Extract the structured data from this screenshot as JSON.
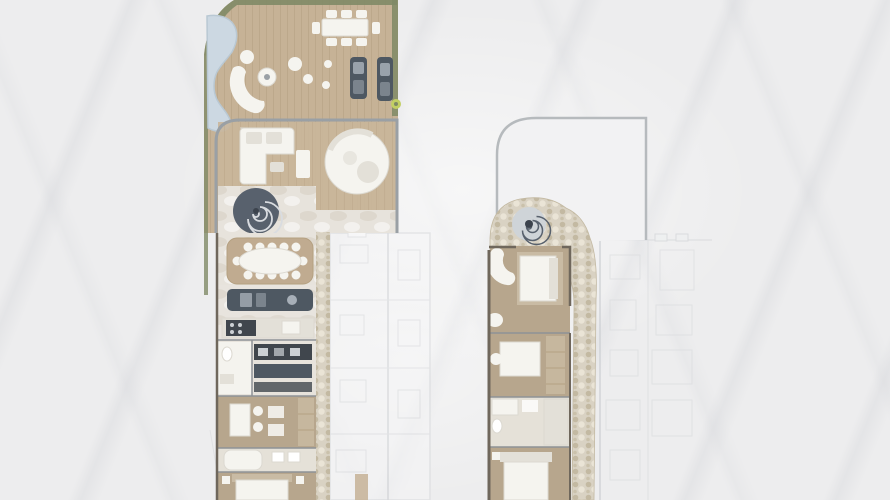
{
  "image_type": "architectural-floorplan-render",
  "visible_text": [],
  "plans": [
    {
      "id": "left-unit",
      "features": [
        "terrace-deck",
        "pool",
        "lounge-seating",
        "outdoor-dining-table",
        "daybeds",
        "planting-edge",
        "living-room",
        "l-shaped-sofa",
        "round-sofa",
        "spiral-staircase",
        "dining-table",
        "kitchen-island",
        "kitchen-counter",
        "wardrobe-shelving",
        "bathroom",
        "office-desks",
        "bathtub",
        "bedroom-bed",
        "stone-wall"
      ]
    },
    {
      "id": "right-unit",
      "features": [
        "terrace-outline",
        "spiral-staircase",
        "stone-wall",
        "bedroom-bed",
        "chaise",
        "dressing-table",
        "closet-cabinets",
        "bathroom-shower",
        "second-bedroom-bed"
      ]
    },
    {
      "id": "ghost-units",
      "features": [
        "faded-neighbor-unit-left",
        "faded-neighbor-unit-right"
      ]
    }
  ],
  "colors": {
    "background": "#ededee",
    "deck-wood": "#c6b296",
    "deck-plank-line": "#b4a081",
    "indoor-wood": "#c9b69b",
    "marble-floor": "#e7e3dc",
    "marble-blotch": "#dbd5c9",
    "pool-water": "#ccd8e2",
    "pool-edge": "#b9c8d3",
    "planting-green": "#7f8a66",
    "plant-accent": "#c2cf63",
    "furniture-white": "#f5f4ef",
    "furniture-shadow": "#e3e0d8",
    "furniture-outline": "#dcd9d1",
    "dark-furniture": "#4e5862",
    "dark-furniture-light": "#a7afb8",
    "dark-cabinet": "#40464d",
    "cabinet-slot": "#ccd0d4",
    "stair-dark": "#58616d",
    "stair-line": "#d9dce0",
    "stair-light": "#cfd4d8",
    "stair-core": "#3c434d",
    "wall-gray": "#9aa0a5",
    "wall-dark": "#6f675c",
    "room-line": "#8e9296",
    "stone-base": "#d9d2c3",
    "stone-fleck-dark": "#c3b9a2",
    "stone-fleck-light": "#eae4d6",
    "tan-floor": "#b7a68d",
    "tan-rug": "#c0ab90",
    "tan-cabinet": "#c6b79e",
    "bed-frame": "#c9bba4",
    "bath-floor": "#e5e1d8",
    "ghost-line": "#d6d8db",
    "ghost-line-strong": "#c9ccd0",
    "ghost-fill": "#f6f6f7",
    "terrace-outline": "#b6babd",
    "terrace-fill": "#f2f2f3"
  }
}
